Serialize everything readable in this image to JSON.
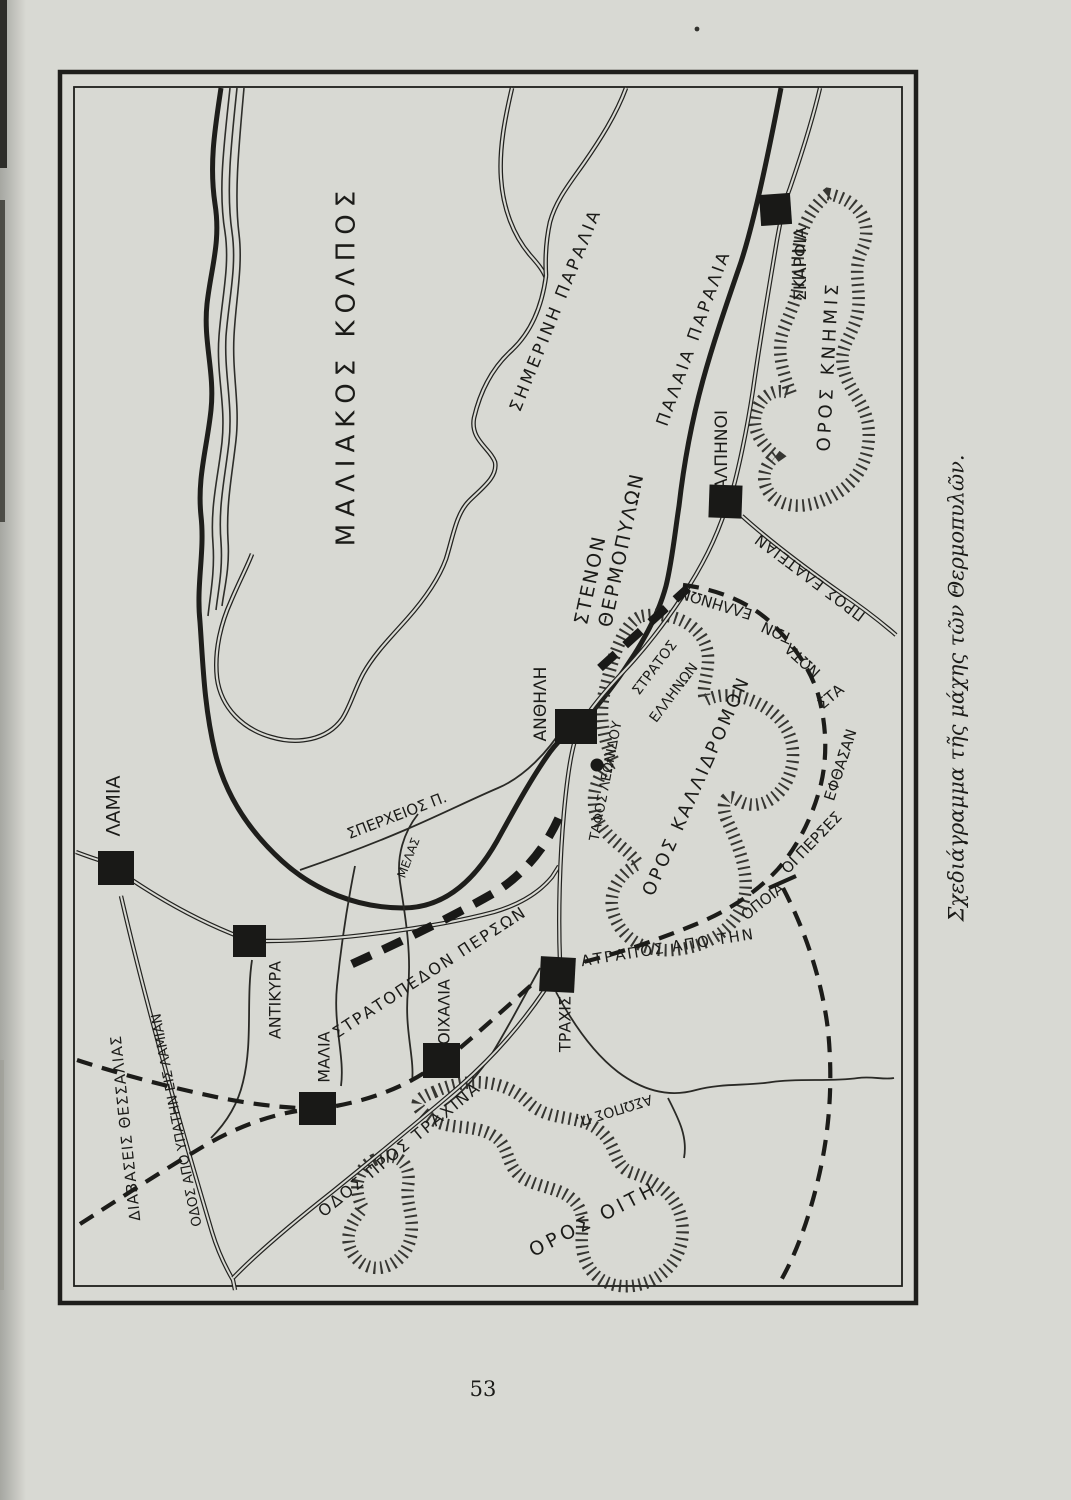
{
  "page_number": "53",
  "caption": "Σχεδιάγραμμα τῆς μάχης τῶν Θερμοπυλῶν.",
  "map": {
    "sea": "ΜΑΛΙΑΚΟΣ ΚΟΛΠΟΣ",
    "coastlines": {
      "modern": "ΣΗΜΕΡΙΝΗ ΠΑΡΑΛΙΑ",
      "old": "ΠΑΛΑΙΑ ΠΑΡΑΛΙΑ"
    },
    "pass": {
      "line1": "ΣΤΕΝΟΝ",
      "line2": "ΘΕΡΜΟΠΥΛΩΝ"
    },
    "towns": {
      "lamia": "ΛΑΜΙΑ",
      "antikyra": "ΑΝΤΙΚΥΡΑ",
      "malia": "ΜΑΛΙΑ",
      "oichalia": "ΟΙΧΑΛΙΑ",
      "trachis": "ΤΡΑΧΙΣ",
      "anthele": "ΑΝΘΗΛΗ",
      "alpenoi": "ΑΛΠΗΝΟΙ",
      "skarphia": "ΣΚΑΡΦΙΑ"
    },
    "mountains": {
      "knemis": "ΟΡΟΣ ΚΝΗΜΙΣ",
      "kallidromon": "ΟΡΟΣ ΚΑΛΛΙΔΡΟΜΟΝ",
      "oeta": "ΟΡΟΣ ΟΙΤΗ"
    },
    "rivers": {
      "spercheios": "ΣΠΕΡΧΕΙΟΣ Π.",
      "melas": "ΜΕΛΑΣ",
      "asopos": "ΑΣΩΠΟΣ Π."
    },
    "military": {
      "greek_army_line1": "ΣΤΡΑΤΟΣ",
      "greek_army_line2": "ΕΛΛΗΝΩΝ",
      "persian_camp": "ΣΤΡΑΤΟΠΕΔΟΝ ΠΕΡΣΩΝ",
      "leonidas_tomb": "ΤΑΦΟΣ ΛΕΩΝΙΔΟΥ"
    },
    "routes": {
      "to_elateia": "ΠΡΟΣ ΕΛΑΤΕΙΑΝ",
      "thessaly_passes": "ΔΙΑΒΑΣΕΙΣ ΘΕΣΣΑΛΙΑΣ",
      "hypata_road": "ΟΔΟΣ ΑΠΟ ΥΠΑΤΗΝ ΕΙΣ ΛΑΜΙΑΝ",
      "trachina_road": "ΟΔΟΣ ΠΡΟΣ ΤΡΑΧΙΝΑ",
      "atrapos_full": "ΑΤΡΑΠΟΣ ΑΠΟ ΤΗΝ ΟΠΟΙΑ ΟΙ ΠΕΡΣΕΣ ΕΦΘΑΣΑΝ ΣΤΑ ΝΩΤΑ ΤΩΝ ΕΛΛΗΝΩΝ",
      "atrapos_segments": [
        "ΑΤΡΑΠΟΣ ΑΠΟ ΤΗΝ",
        "ΟΠΟΙΑ",
        "ΟΙ ΠΕΡΣΕΣ",
        "ΕΦΘΑΣΑΝ",
        "ΣΤΑ",
        "ΝΩΤΑ",
        "ΤΩΝ",
        "ΕΛΛΗΝΩΝ"
      ]
    },
    "colors": {
      "ink": "#1c1c1a",
      "paper": "#d8d9d3"
    }
  }
}
